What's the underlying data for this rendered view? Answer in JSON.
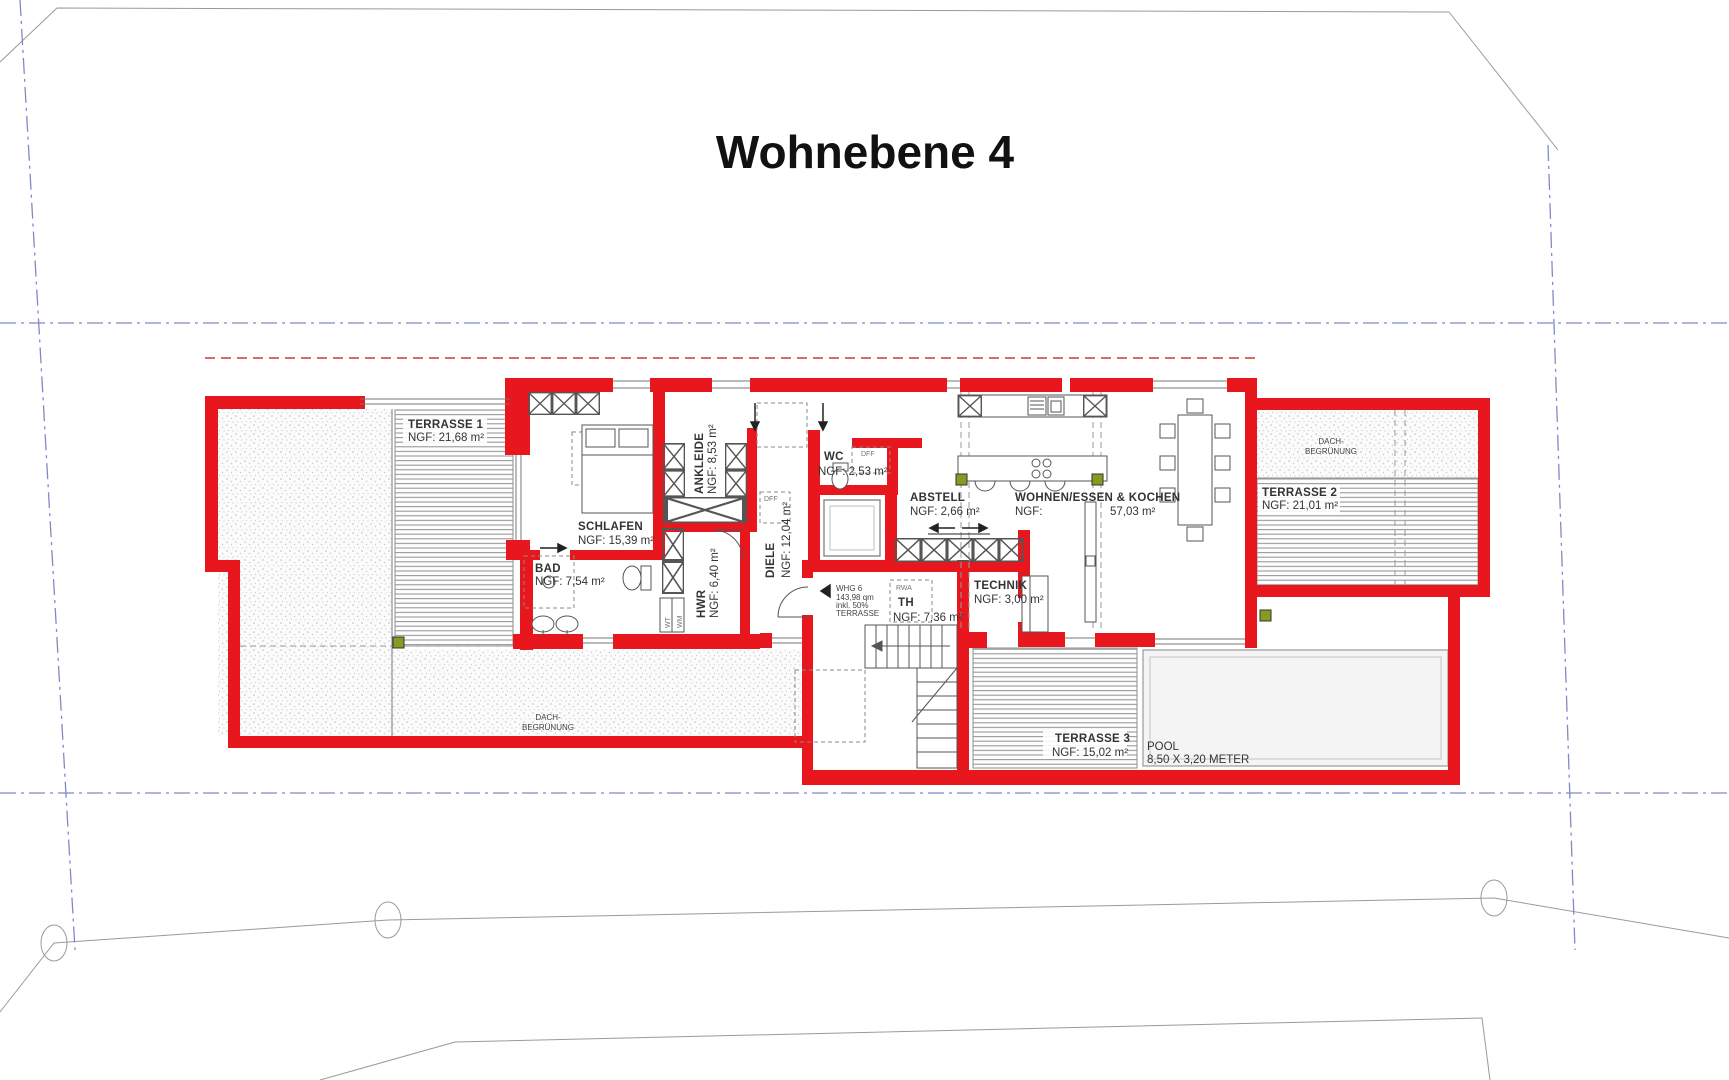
{
  "title": "Wohnebene 4",
  "rooms": {
    "terrasse1": {
      "name": "TERRASSE 1",
      "area": "NGF: 21,68 m²"
    },
    "schlafen": {
      "name": "SCHLAFEN",
      "area": "NGF: 15,39 m²"
    },
    "bad": {
      "name": "BAD",
      "area": "NGF: 7,54 m²"
    },
    "ankleide": {
      "name": "ANKLEIDE",
      "area": "NGF: 8,53 m²"
    },
    "hwr": {
      "name": "HWR",
      "area": "NGF: 6,40 m²"
    },
    "diele": {
      "name": "DIELE",
      "area": "NGF: 12,04 m²"
    },
    "wc": {
      "name": "WC",
      "area": "NGF: 2,53 m²"
    },
    "abstell": {
      "name": "ABSTELL",
      "area": "NGF: 2,66 m²"
    },
    "wohnen": {
      "name": "WOHNEN/ESSEN & KOCHEN",
      "area_label": "NGF:",
      "area_value": "57,03 m²"
    },
    "technik": {
      "name": "TECHNIK",
      "area": "NGF: 3,00 m²"
    },
    "th": {
      "name": "TH",
      "area": "NGF: 7,36 m²"
    },
    "terrasse2": {
      "name": "TERRASSE 2",
      "area": "NGF: 21,01 m²"
    },
    "terrasse3": {
      "name": "TERRASSE 3",
      "area": "NGF: 15,02 m²"
    },
    "pool": {
      "name": "POOL",
      "dimensions": "8,50 X 3,20 METER"
    }
  },
  "annotations": {
    "dach_line1": "DACH-",
    "dach_line2": "BEGRÜNUNG",
    "whg_line1": "WHG 6",
    "whg_line2": "143,98 qm",
    "whg_line3": "inkl. 50%",
    "whg_line4": "TERRASSE",
    "rwa": "RWA",
    "dff": "DFF",
    "wt": "WT",
    "wm": "WM"
  },
  "colors": {
    "wall_red": "#e8161d",
    "property_line_blue": "#8089c8",
    "roof_dashed_red": "#d23a30",
    "site_line_gray": "#9a9a9a",
    "marker_green": "#8a9a20"
  }
}
